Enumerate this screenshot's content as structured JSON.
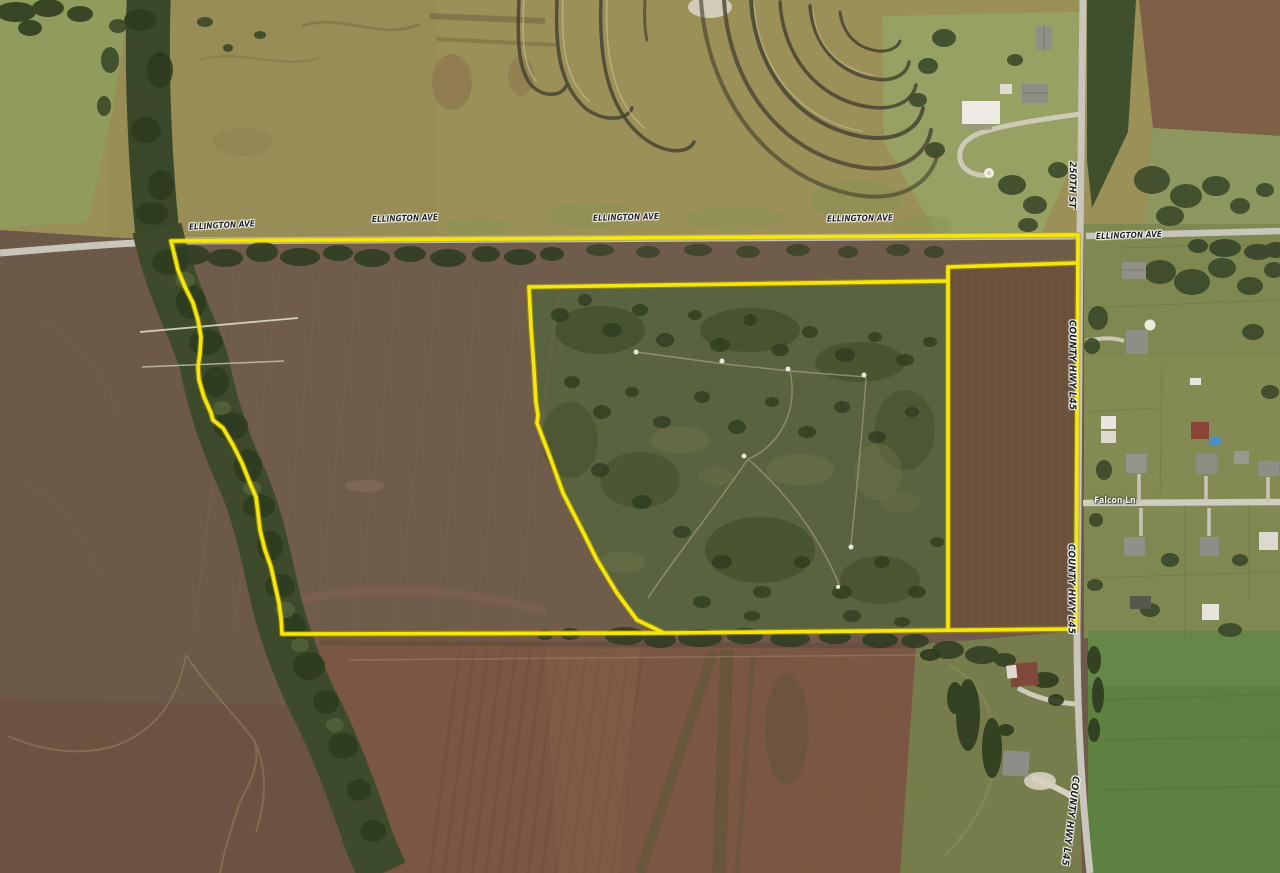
{
  "map": {
    "kind": "aerial-parcel-boundary-map",
    "boundary_color": "#f6e70a",
    "road_labels": {
      "ellington_1": "ELLINGTON AVE",
      "ellington_2": "ELLINGTON AVE",
      "ellington_3": "ELLINGTON AVE",
      "ellington_4": "ELLINGTON AVE",
      "ellington_east": "ELLINGTON AVE",
      "street_250th": "250TH ST",
      "county_hwy_north": "COUNTY HWY L45",
      "county_hwy_south": "COUNTY HWY L45",
      "county_hwy_bottom": "COUNTY HWY L45",
      "falcon_ln": "Falcon Ln"
    }
  }
}
